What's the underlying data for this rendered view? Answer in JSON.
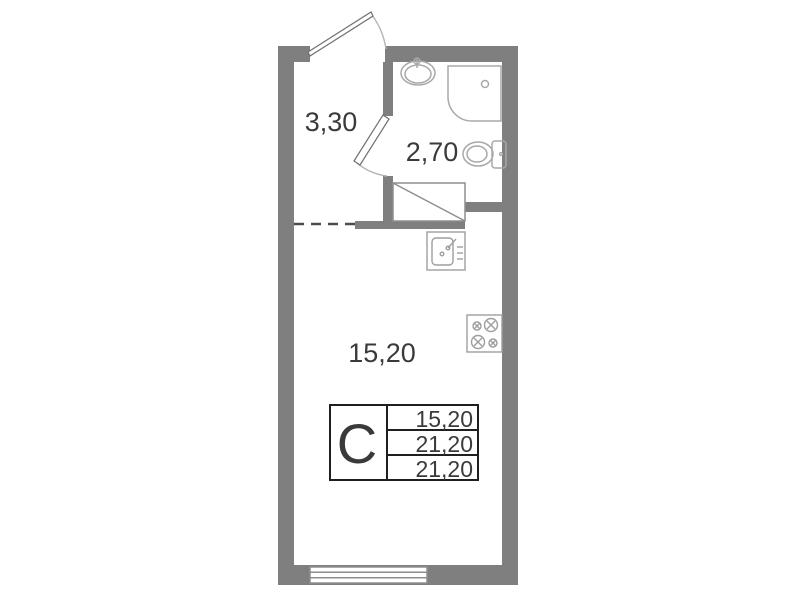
{
  "colors": {
    "wall": "#7f7f7f",
    "fixture": "#a8a8a8",
    "door": "#6f6f6f",
    "arc": "#b4b4b4",
    "dashed_boundary": "#4c4c4c",
    "text": "#3a3a3a",
    "table_border": "#1f1f1f"
  },
  "rooms": {
    "hallway": {
      "area": "3,30"
    },
    "bathroom": {
      "area": "2,70"
    },
    "living_room": {
      "area": "15,20"
    }
  },
  "legend": {
    "unit_type": "С",
    "rows": [
      "15,20",
      "21,20",
      "21,20"
    ]
  },
  "icons": [
    "entrance-door-icon",
    "bathroom-door-icon",
    "washbasin-icon",
    "shower-tray-icon",
    "toilet-icon",
    "duct-shaft-icon",
    "kitchen-sink-icon",
    "cooktop-icon",
    "window-icon"
  ]
}
